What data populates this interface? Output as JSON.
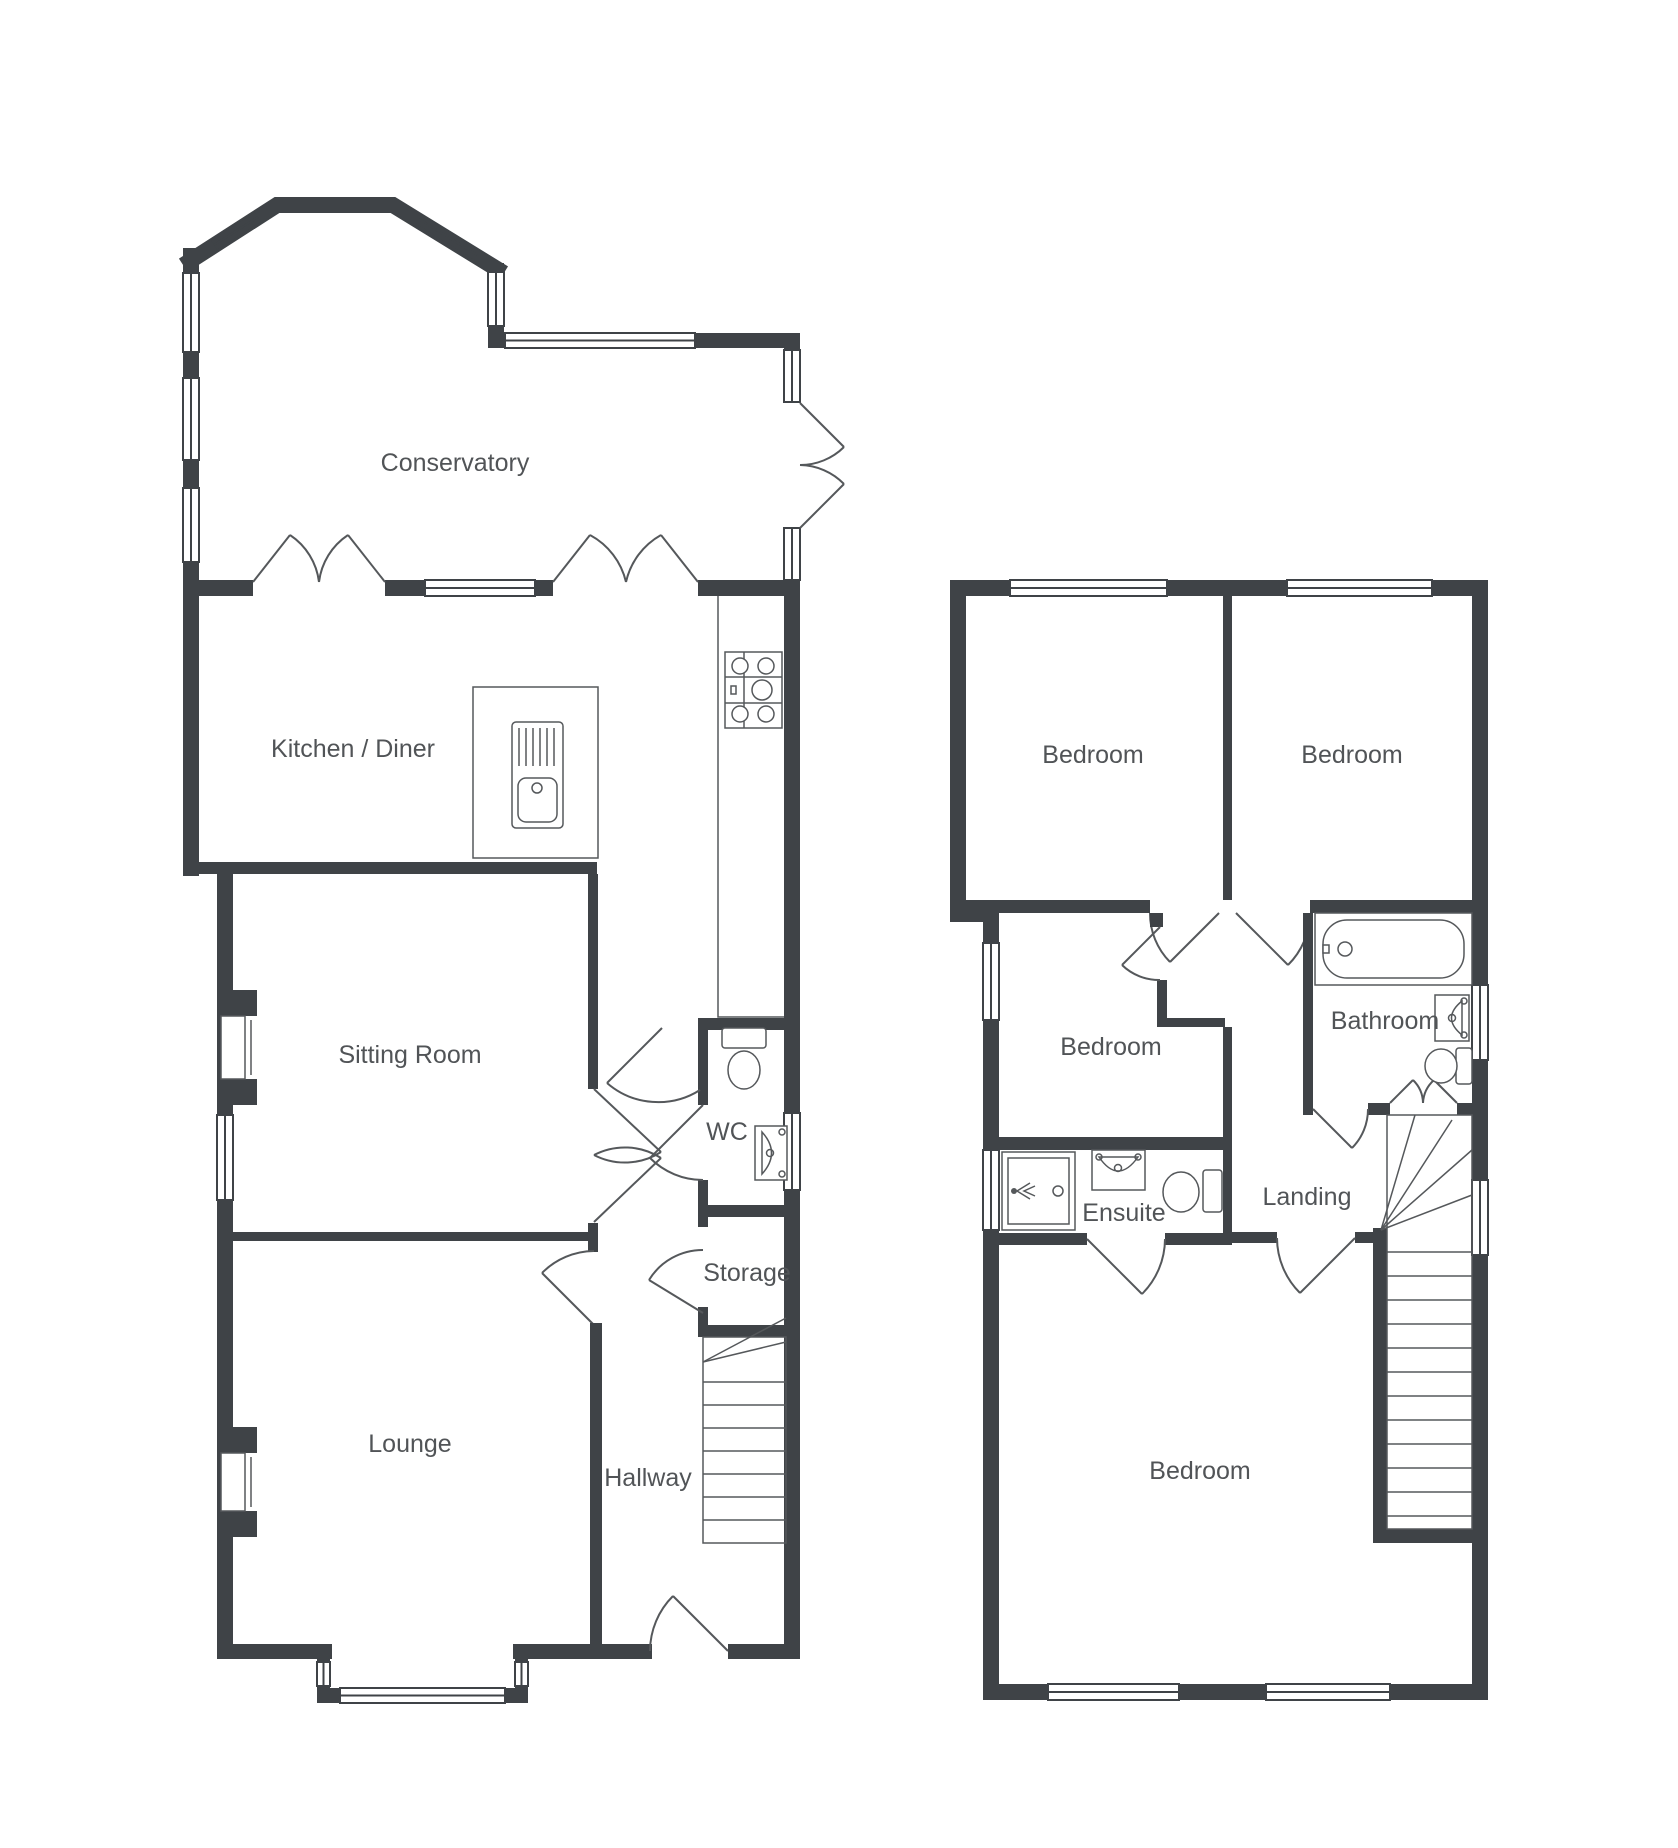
{
  "title": "Two storey house floorplan",
  "colors": {
    "wall": "#3F4347",
    "line": "#55585B",
    "text": "#515457",
    "background": "#FFFFFF"
  },
  "floors": [
    {
      "name": "ground-floor",
      "rooms": [
        {
          "id": "conservatory",
          "label": "Conservatory"
        },
        {
          "id": "kitchen-diner",
          "label": "Kitchen / Diner"
        },
        {
          "id": "sitting-room",
          "label": "Sitting Room"
        },
        {
          "id": "wc",
          "label": "WC"
        },
        {
          "id": "storage",
          "label": "Storage"
        },
        {
          "id": "lounge",
          "label": "Lounge"
        },
        {
          "id": "hallway",
          "label": "Hallway"
        }
      ],
      "fixtures": [
        "bay-window",
        "french-doors",
        "patio-double-doors",
        "kitchen-island-sink",
        "hob",
        "worktop-counter",
        "toilet",
        "wash-basin",
        "fireplace",
        "fireplace",
        "staircase",
        "front-door",
        "bay-window"
      ]
    },
    {
      "name": "first-floor",
      "rooms": [
        {
          "id": "bedroom-1",
          "label": "Bedroom"
        },
        {
          "id": "bedroom-2",
          "label": "Bedroom"
        },
        {
          "id": "bedroom-3",
          "label": "Bedroom"
        },
        {
          "id": "bathroom",
          "label": "Bathroom"
        },
        {
          "id": "ensuite",
          "label": "Ensuite"
        },
        {
          "id": "landing",
          "label": "Landing"
        },
        {
          "id": "bedroom-4",
          "label": "Bedroom"
        }
      ],
      "fixtures": [
        "bath-tub",
        "wash-basin",
        "toilet",
        "shower-cubicle",
        "wash-basin",
        "toilet",
        "staircase",
        "cupboard-doors"
      ]
    }
  ]
}
